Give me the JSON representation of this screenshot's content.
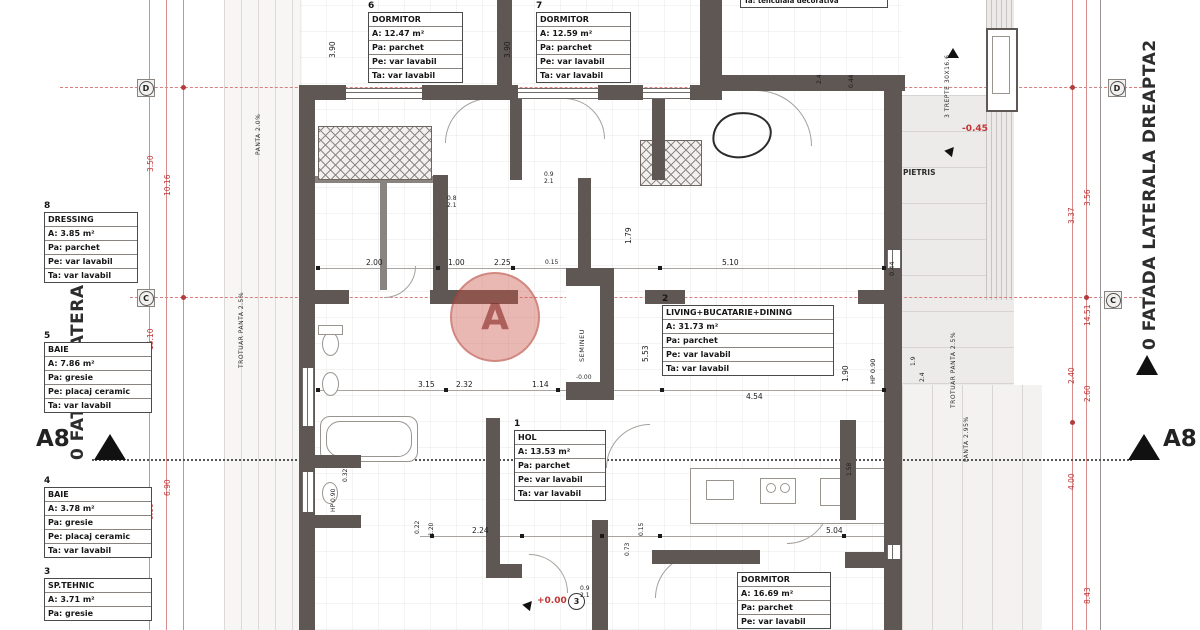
{
  "facades": {
    "left": "0 FATADA LATERALA",
    "right": "0 FATADA LATERALA DREAPTA2"
  },
  "section_label": "A8",
  "axis_markers": {
    "d": "D",
    "c": "C"
  },
  "levels": {
    "minus45": "-0.45",
    "zero": "+0.00",
    "semineu_level": "-0.00"
  },
  "notes": {
    "top_finish": "Ta: tencuiala decorativa",
    "pietris": "PIETRIS",
    "semineu": "SEMINEU",
    "trepte": "3 TREPTE 30X16.6",
    "trotuar_left": "TROTUAR PANTA 2.5%",
    "panta_left": "PANTA 2.0%",
    "trotuar_right": "TROTUAR PANTA 2.5%",
    "panta_right": "PANTA 2.95%",
    "watermark_letter": "A"
  },
  "rooms": [
    {
      "num": "6",
      "name": "DORMITOR",
      "area": "A: 12.47 m²",
      "pa": "Pa: parchet",
      "pe": "Pe: var lavabil",
      "ta": "Ta: var lavabil"
    },
    {
      "num": "7",
      "name": "DORMITOR",
      "area": "A: 12.59 m²",
      "pa": "Pa: parchet",
      "pe": "Pe: var lavabil",
      "ta": "Ta: var lavabil"
    },
    {
      "num": "8",
      "name": "DRESSING",
      "area": "A: 3.85 m²",
      "pa": "Pa: parchet",
      "pe": "Pe: var lavabil",
      "ta": "Ta: var lavabil"
    },
    {
      "num": "5",
      "name": "BAIE",
      "area": "A: 7.86 m²",
      "pa": "Pa: gresie",
      "pe": "Pe: placaj ceramic",
      "ta": "Ta: var lavabil"
    },
    {
      "num": "4",
      "name": "BAIE",
      "area": "A: 3.78 m²",
      "pa": "Pa: gresie",
      "pe": "Pe: placaj ceramic",
      "ta": "Ta: var lavabil"
    },
    {
      "num": "3",
      "name": "SP.TEHNIC",
      "area": "A: 3.71 m²",
      "pa": "Pa: gresie"
    },
    {
      "num": "1",
      "name": "HOL",
      "area": "A: 13.53 m²",
      "pa": "Pa: parchet",
      "pe": "Pe: var lavabil",
      "ta": "Ta: var lavabil"
    },
    {
      "num": "2",
      "name": "LIVING+BUCATARIE+DINING",
      "area": "A: 31.73 m²",
      "pa": "Pa: parchet",
      "pe": "Pe: var lavabil",
      "ta": "Ta: var lavabil"
    },
    {
      "num": "",
      "name": "DORMITOR",
      "area": "A: 16.69 m²",
      "pa": "Pa: parchet",
      "pe": "Pe: var lavabil"
    }
  ],
  "red_dims_left": [
    "3.50",
    "10.16",
    "15.10",
    "6.90",
    "0.60"
  ],
  "red_dims_right": [
    "3.56",
    "3.37",
    "14.51",
    "2.40",
    "2.60",
    "4.00",
    "8.43"
  ],
  "dims": [
    "3.90",
    "3.90",
    "2.00",
    "1.00",
    "2.25",
    "0.15",
    "5.10",
    "0.44",
    "1.79",
    "5.53",
    "3.15",
    "2.32",
    "1.14",
    "4.54",
    "1.90",
    "HP 0.90",
    "2.24",
    "5.04",
    "0.22",
    "1.20",
    "0.73",
    "0.15",
    "1.58",
    "2.4",
    "0.44",
    "1.9",
    "2.4",
    "HP 0.90",
    "0.32"
  ],
  "doors": [
    {
      "w": "0.8",
      "h": "2.1"
    },
    {
      "w": "0.9",
      "h": "2.1"
    },
    {
      "w": "0.9",
      "h": "2.1"
    }
  ],
  "door_tag_number": "3"
}
